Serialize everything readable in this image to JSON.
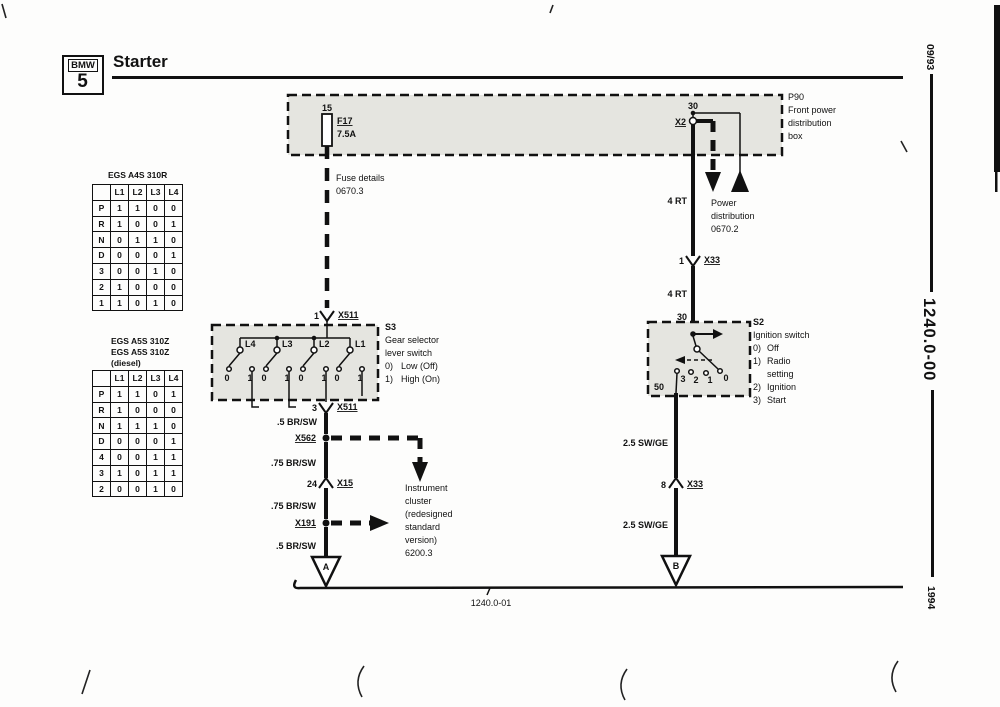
{
  "header": {
    "logo_top": "BMW",
    "logo_number": "5",
    "title": "Starter"
  },
  "sidebar_codes": {
    "issue_date": "09/93",
    "document_number": "1240.0-00",
    "model_year": "1994"
  },
  "shift_lever_tables": [
    {
      "title_lines": [
        "EGS A4S 310R"
      ],
      "columns": [
        "",
        "L1",
        "L2",
        "L3",
        "L4"
      ],
      "rows": [
        [
          "P",
          "1",
          "1",
          "0",
          "0"
        ],
        [
          "R",
          "1",
          "0",
          "0",
          "1"
        ],
        [
          "N",
          "0",
          "1",
          "1",
          "0"
        ],
        [
          "D",
          "0",
          "0",
          "0",
          "1"
        ],
        [
          "3",
          "0",
          "0",
          "1",
          "0"
        ],
        [
          "2",
          "1",
          "0",
          "0",
          "0"
        ],
        [
          "1",
          "1",
          "0",
          "1",
          "0"
        ]
      ]
    },
    {
      "title_lines": [
        "EGS A5S 310Z",
        "EGS A5S 310Z",
        "(diesel)"
      ],
      "columns": [
        "",
        "L1",
        "L2",
        "L3",
        "L4"
      ],
      "rows": [
        [
          "P",
          "1",
          "1",
          "0",
          "1"
        ],
        [
          "R",
          "1",
          "0",
          "0",
          "0"
        ],
        [
          "N",
          "1",
          "1",
          "1",
          "0"
        ],
        [
          "D",
          "0",
          "0",
          "0",
          "1"
        ],
        [
          "4",
          "0",
          "0",
          "1",
          "1"
        ],
        [
          "3",
          "1",
          "0",
          "1",
          "1"
        ],
        [
          "2",
          "0",
          "0",
          "1",
          "0"
        ]
      ]
    }
  ],
  "diagram": {
    "p90": {
      "code": "P90",
      "line2": "Front power",
      "line3": "distribution",
      "line4": "box",
      "terminal_15": "15",
      "terminal_30": "30",
      "fuse_name": "F17",
      "fuse_rating": "7.5A",
      "x2": "X2"
    },
    "fuse_details": {
      "line1": "Fuse details",
      "line2": "0670.3"
    },
    "power_distribution": {
      "line1": "Power",
      "line2": "distribution",
      "line3": "0670.2"
    },
    "instrument_cluster": {
      "line1": "Instrument",
      "line2": "cluster",
      "line3": "(redesigned",
      "line4": "standard",
      "line5": "version)",
      "line6": "6200.3"
    },
    "s3": {
      "code": "S3",
      "line2": "Gear selector",
      "line3": "lever switch",
      "opt0_key": "0)",
      "opt0_val": "Low (Off)",
      "opt1_key": "1)",
      "opt1_val": "High (On)",
      "sw_l4": "L4",
      "sw_l3": "L3",
      "sw_l2": "L2",
      "sw_l1": "L1",
      "contact_0": "0",
      "contact_1": "1",
      "pin_in": "1",
      "conn_in": "X511",
      "pin_out": "3",
      "conn_out": "X511"
    },
    "s2": {
      "code": "S2",
      "line2": "Ignition switch",
      "opt0_key": "0)",
      "opt0_val": "Off",
      "opt1_key": "1)",
      "opt1_val": "Radio",
      "opt1_val2": "setting",
      "opt2_key": "2)",
      "opt2_val": "Ignition",
      "opt3_key": "3)",
      "opt3_val": "Start",
      "terminal_30": "30",
      "terminal_50": "50",
      "contact_3": "3",
      "contact_2": "2",
      "contact_1": "1",
      "contact_0": "0"
    },
    "wires": {
      "rt_upper": "4 RT",
      "rt_lower": "4 RT",
      "brsw_05_upper": ".5 BR/SW",
      "brsw_75_upper": ".75 BR/SW",
      "brsw_75_lower": ".75 BR/SW",
      "brsw_05_lower": ".5 BR/SW",
      "swge_upper": "2.5 SW/GE",
      "swge_lower": "2.5 SW/GE"
    },
    "connectors": {
      "x562": "X562",
      "x191": "X191",
      "x15_pin": "24",
      "x15": "X15",
      "x33_upper_pin": "1",
      "x33_upper": "X33",
      "x33_lower_pin": "8",
      "x33_lower": "X33"
    },
    "continuation_a": "A",
    "continuation_b": "B",
    "footer_ref": "1240.0-01"
  }
}
